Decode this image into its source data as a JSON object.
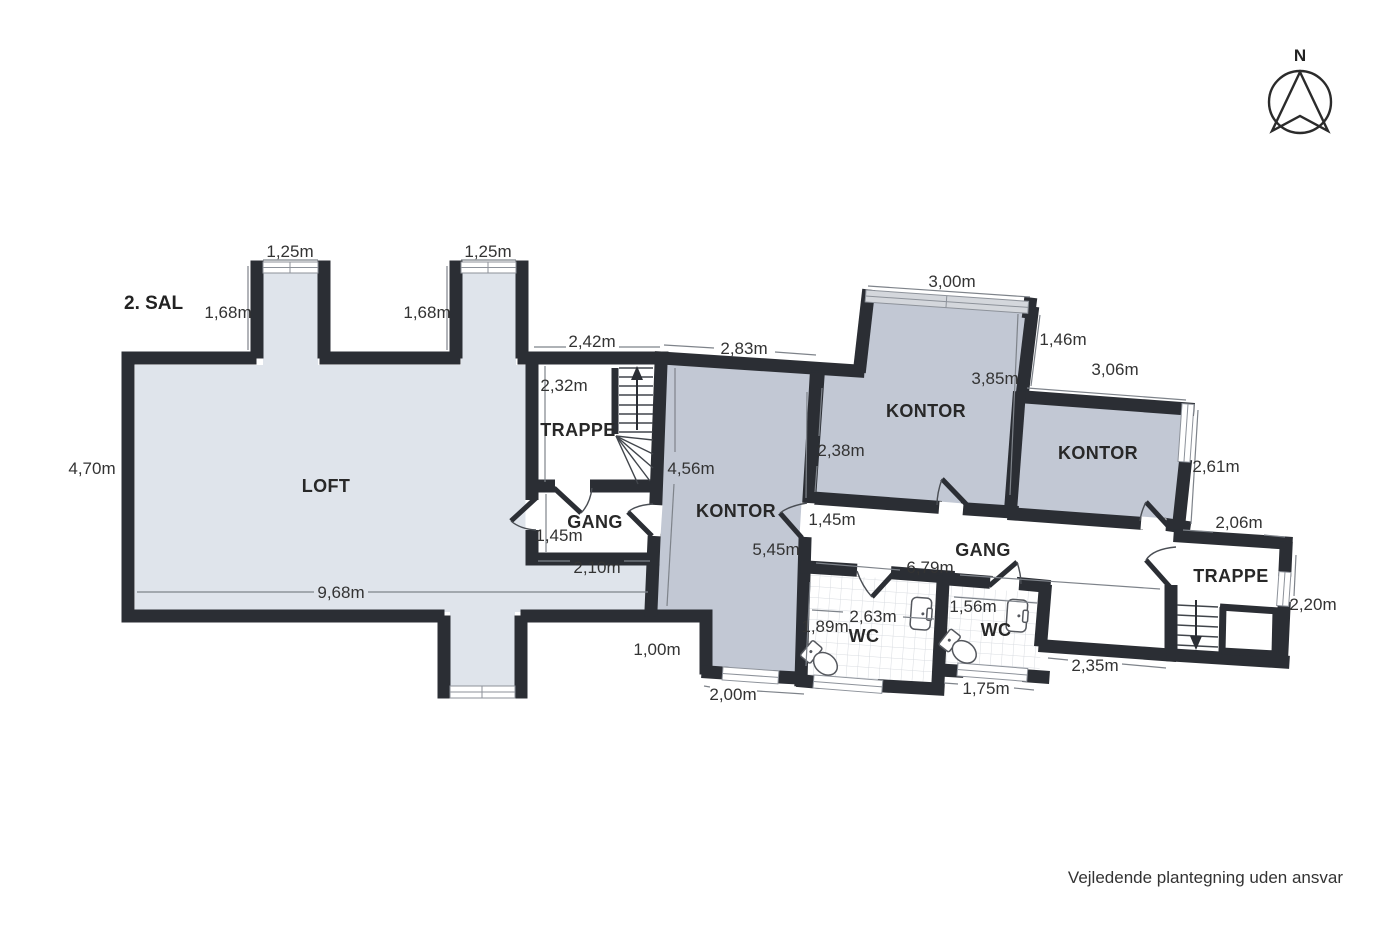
{
  "title": "2. SAL",
  "compass": {
    "north_label": "N"
  },
  "disclaimer": "Vejledende plantegning uden ansvar",
  "rooms": {
    "loft": "LOFT",
    "trappe_left": "TRAPPE",
    "gang_left": "GANG",
    "kontor_left": "KONTOR",
    "kontor_mid": "KONTOR",
    "kontor_right": "KONTOR",
    "gang_right": "GANG",
    "wc_left": "WC",
    "wc_right": "WC",
    "trappe_right": "TRAPPE"
  },
  "dimensions": {
    "dormer1_width": "1,25m",
    "dormer2_width": "1,25m",
    "dormer1_depth": "1,68m",
    "dormer2_depth": "1,68m",
    "loft_height": "4,70m",
    "loft_width": "9,68m",
    "top_wall_left": "2,42m",
    "trappe_left_height": "2,32m",
    "kontor_left_top": "2,83m",
    "kontor_left_height": "4,56m",
    "kontor_left_full": "5,45m",
    "gang_left_width": "1,45m",
    "gang_left_bottom": "2,10m",
    "kontor_mid_window": "3,00m",
    "kontor_mid_left": "2,38m",
    "kontor_mid_height": "3,85m",
    "jog_wall": "1,46m",
    "kontor_right_top": "3,06m",
    "kontor_right_side": "2,61m",
    "gang_right_door": "1,45m",
    "gang_right_length": "6,79m",
    "trappe_right_top": "2,06m",
    "trappe_right_side": "2,20m",
    "step_height": "1,00m",
    "kontor_left_window": "2,00m",
    "wc_left_height": "1,89m",
    "wc_left_width": "2,63m",
    "wc_right_width": "1,56m",
    "wc_right_window": "1,75m",
    "bottom_wall_right": "2,35m"
  },
  "colors": {
    "wall": "#2b2e34",
    "loft_fill": "#dfe4eb",
    "office_fill": "#c2c8d4",
    "tile_line": "#d9dce1",
    "dim_line": "#7e838a",
    "text": "#333333",
    "arc": "#4a4e54",
    "win_line": "#8d929a",
    "win_gray": "#d4d7dc"
  }
}
